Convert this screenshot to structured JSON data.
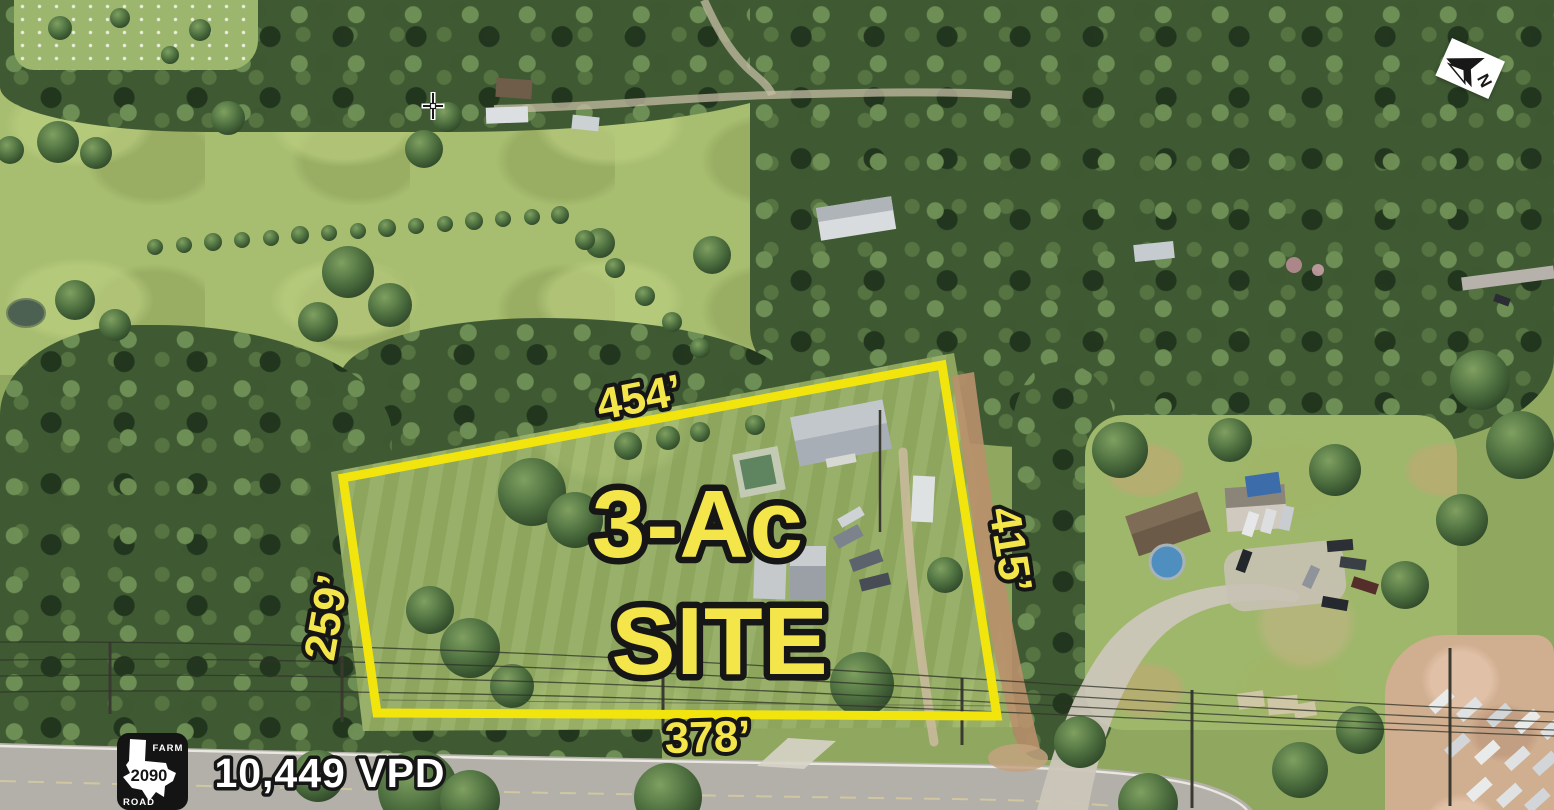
{
  "annotations": {
    "site_line1": "3-Ac",
    "site_line2": "SITE",
    "dim_top": "454’",
    "dim_left": "259’",
    "dim_right": "415’",
    "dim_bottom": "378’",
    "traffic_count": "10,449 VPD"
  },
  "road_shield": {
    "top_word": "FARM",
    "route_number": "2090",
    "bottom_word": "ROAD"
  },
  "north_arrow": {
    "letter": "N"
  },
  "colors": {
    "boundary_yellow": "#F2E40D",
    "label_yellow": "#F4E64A",
    "label_outline": "#161616",
    "traffic_text": "#FFFFFF",
    "shield_background": "#141414",
    "shield_state_shape": "#FFFFFF"
  },
  "icons": {
    "north_arrow_icon": "N",
    "crosshair_cursor_icon": "+",
    "texas_fm_road_shield_icon": "TX"
  }
}
